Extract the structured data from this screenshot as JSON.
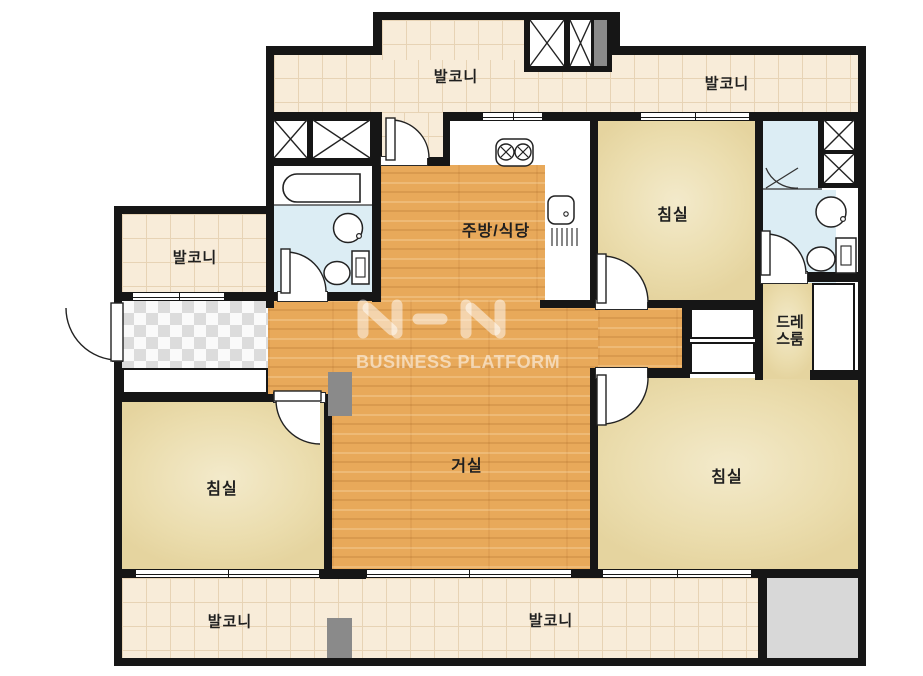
{
  "title": "아파트 평면도",
  "watermark": {
    "logo_text": "NHN",
    "tagline": "BUSINESS PLATFORM"
  },
  "rooms": {
    "balcony_top_left": "발코니",
    "balcony_top_right": "발코니",
    "balcony_left": "발코니",
    "balcony_bottom_left": "발코니",
    "balcony_bottom_center": "발코니",
    "kitchen_dining": "주방/식당",
    "living_room": "거실",
    "bedroom_top_right": "침실",
    "bedroom_bottom_left": "침실",
    "bedroom_bottom_right": "침실",
    "dress_room_line1": "드레",
    "dress_room_line2": "스룸"
  },
  "colors": {
    "wall": "#161616",
    "wood_floor": "#e8a95a",
    "bedroom_floor": "#ebddae",
    "balcony_tile": "#f8ecd9",
    "bathroom_floor": "#dcedf4",
    "gray_unit": "#8a8a8a",
    "light_gray_area": "#d8d8d8",
    "watermark_color": "rgba(255,255,255,0.55)"
  }
}
